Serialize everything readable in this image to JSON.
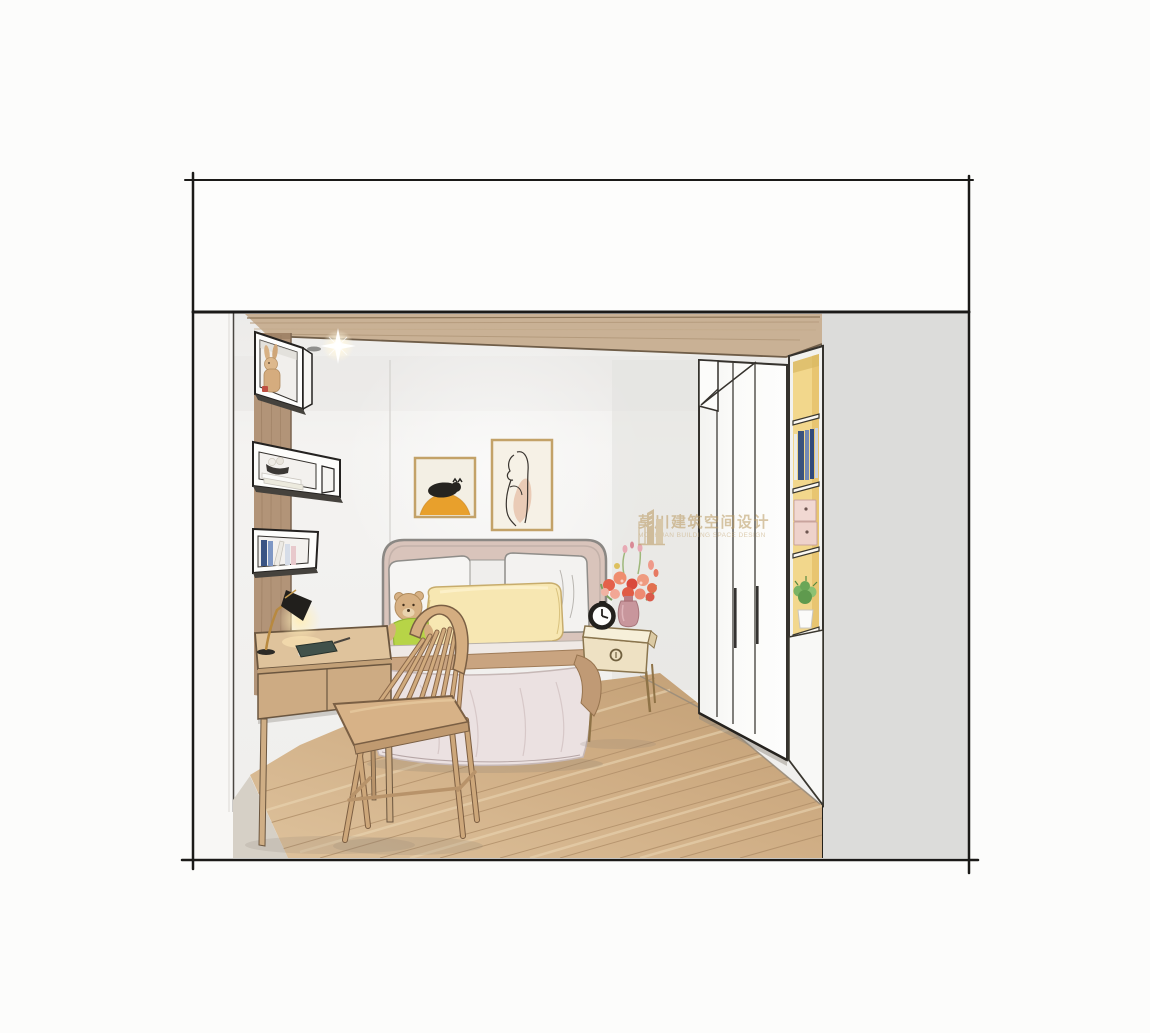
{
  "title": "Bedroom interior design hand-drawn rendering",
  "watermark": {
    "cn": "莫川建筑空间设计",
    "en": "MOCHUAN BUILDING SPACE DESIGN",
    "color": "#b9995f"
  },
  "palette": {
    "back_wall": "#f2f1ef",
    "right_side_panel": "#dcdcda",
    "ceiling_wood": "#c9b195",
    "floor_wood": "#cfad84",
    "shelf_interior_yellow": "#f2d78c",
    "headboard_blush": "#d9c4bb",
    "duvet_pink_white": "#ebe1e1",
    "bolster_yellow": "#f7e7b2",
    "furniture_wood": "#d4ae82",
    "sketch_line": "#1b1a18"
  },
  "objects": [
    "ceiling soffit with recessed spotlight",
    "three wall box shelves (plush rabbit, bowl decor and stacked books, standing books)",
    "wood writing desk with black task lamp, dark notebook and pen",
    "windsor style wood chair",
    "double bed with blush headboard, white pillows, yellow bolster and teddy bear",
    "framed artwork: black cat on orange mound",
    "framed artwork: woman line art",
    "nightstand with black alarm clock and coral flower bouquet in vase",
    "white wardrobe with vertical door handles",
    "open shelf column with books, pink storage boxes and potted plant",
    "diagonal oak plank floor"
  ]
}
